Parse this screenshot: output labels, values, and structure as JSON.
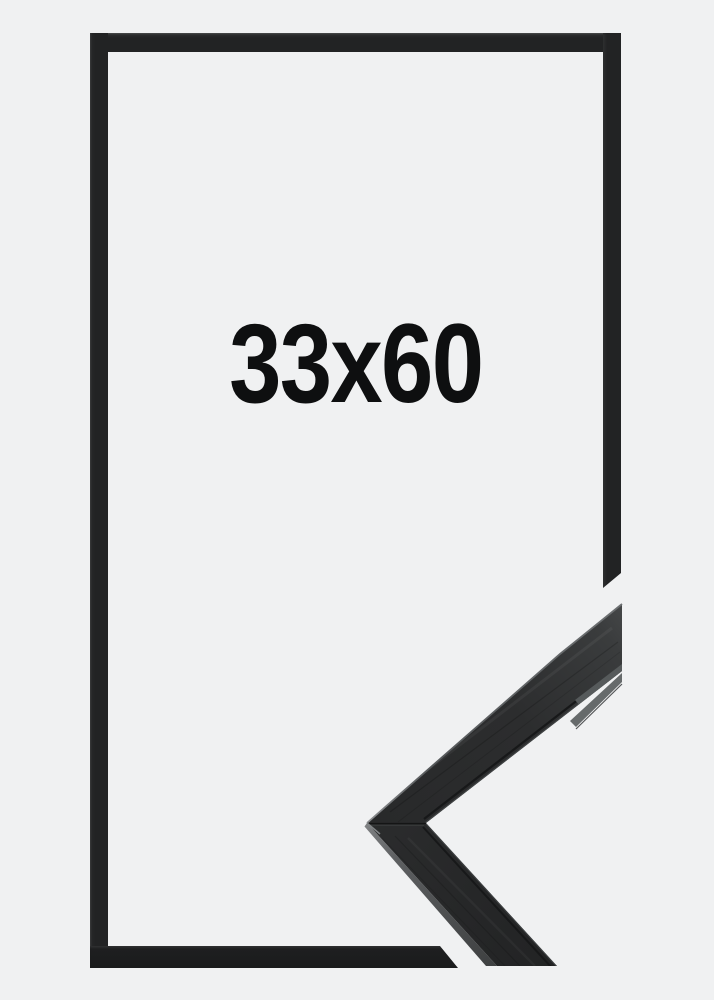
{
  "product": {
    "size_label": "33x60"
  },
  "graphics": {
    "frame_outline": "thin black rectangular frame outline, right and bottom bars cut diagonally near the lower-right corner",
    "corner_detail": "photographic close-up of black wooden frame moulding mitred corner, chevron pointing left, clipped at right and bottom edges"
  },
  "colors": {
    "background": "#f0f1f2",
    "frame": "#222324",
    "text": "#0e0f10",
    "detail_face": "#2b2c2d",
    "detail_highlight": "#7a7d7f"
  }
}
